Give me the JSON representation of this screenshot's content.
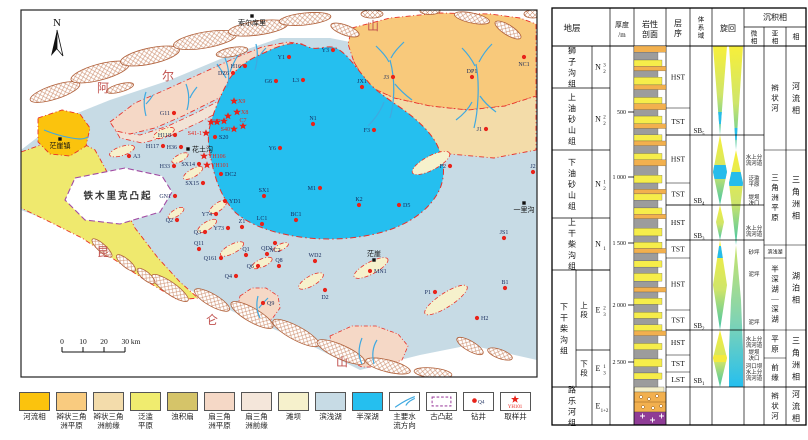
{
  "figure": {
    "bg": "#ffffff"
  },
  "map": {
    "north": "N",
    "mountain_labels": [
      {
        "t": "阿",
        "x": 103,
        "y": 92
      },
      {
        "t": "尔",
        "x": 168,
        "y": 80
      },
      {
        "t": "山",
        "x": 373,
        "y": 30
      },
      {
        "t": "昆",
        "x": 103,
        "y": 256
      },
      {
        "t": "仑",
        "x": 212,
        "y": 324
      },
      {
        "t": "山",
        "x": 342,
        "y": 366
      }
    ],
    "uplift_label": "铁木里克凸起",
    "towns": [
      {
        "n": "索尔库里",
        "x": 252,
        "y": 16,
        "p": "b"
      },
      {
        "n": "茫崖镇",
        "x": 60,
        "y": 139,
        "p": "b"
      },
      {
        "n": "花土沟",
        "x": 188,
        "y": 149,
        "p": "r"
      },
      {
        "n": "茫崖",
        "x": 374,
        "y": 260,
        "p": "t"
      },
      {
        "n": "一里沟",
        "x": 524,
        "y": 203,
        "p": "b"
      }
    ],
    "scale_bar": {
      "ticks": [
        "0",
        "10",
        "20",
        "30"
      ],
      "unit": "km"
    },
    "wells": [
      {
        "n": "H16",
        "x": 245,
        "y": 66,
        "p": "l"
      },
      {
        "n": "G6",
        "x": 276,
        "y": 81,
        "p": "l"
      },
      {
        "n": "Y1",
        "x": 289,
        "y": 57,
        "p": "l"
      },
      {
        "n": "Y3",
        "x": 333,
        "y": 50,
        "p": "l"
      },
      {
        "n": "L3",
        "x": 303,
        "y": 80,
        "p": "l"
      },
      {
        "n": "JX1",
        "x": 362,
        "y": 87,
        "p": "t"
      },
      {
        "n": "J3",
        "x": 393,
        "y": 77,
        "p": "l"
      },
      {
        "n": "DP1",
        "x": 472,
        "y": 77,
        "p": "t"
      },
      {
        "n": "NC1",
        "x": 524,
        "y": 57,
        "p": "b"
      },
      {
        "n": "J1",
        "x": 486,
        "y": 129,
        "p": "l"
      },
      {
        "n": "N1",
        "x": 313,
        "y": 124,
        "p": "t"
      },
      {
        "n": "F3",
        "x": 374,
        "y": 130,
        "p": "l"
      },
      {
        "n": "F2",
        "x": 450,
        "y": 166,
        "p": "l"
      },
      {
        "n": "J2",
        "x": 533,
        "y": 172,
        "p": "t"
      },
      {
        "n": "M1",
        "x": 320,
        "y": 188,
        "p": "l"
      },
      {
        "n": "K2",
        "x": 359,
        "y": 205,
        "p": "t"
      },
      {
        "n": "D5",
        "x": 399,
        "y": 205,
        "p": "r"
      },
      {
        "n": "BC1",
        "x": 296,
        "y": 220,
        "p": "t"
      },
      {
        "n": "JS1",
        "x": 504,
        "y": 238,
        "p": "t"
      },
      {
        "n": "B1",
        "x": 505,
        "y": 288,
        "p": "t"
      },
      {
        "n": "H2",
        "x": 477,
        "y": 318,
        "p": "r"
      },
      {
        "n": "P1",
        "x": 435,
        "y": 292,
        "p": "l"
      },
      {
        "n": "MN1",
        "x": 370,
        "y": 271,
        "p": "r"
      },
      {
        "n": "WD2",
        "x": 315,
        "y": 261,
        "p": "t"
      },
      {
        "n": "D2",
        "x": 325,
        "y": 290,
        "p": "b"
      },
      {
        "n": "Q9",
        "x": 263,
        "y": 303,
        "p": "r"
      },
      {
        "n": "Q4",
        "x": 236,
        "y": 276,
        "p": "l"
      },
      {
        "n": "Q161",
        "x": 221,
        "y": 258,
        "p": "l"
      },
      {
        "n": "Q11",
        "x": 199,
        "y": 249,
        "p": "t"
      },
      {
        "n": "Q1",
        "x": 246,
        "y": 255,
        "p": "t"
      },
      {
        "n": "QD1",
        "x": 267,
        "y": 254,
        "p": "t"
      },
      {
        "n": "Q6",
        "x": 258,
        "y": 266,
        "p": "l"
      },
      {
        "n": "Q8",
        "x": 279,
        "y": 266,
        "p": "t"
      },
      {
        "n": "Q3",
        "x": 205,
        "y": 232,
        "p": "l"
      },
      {
        "n": "Q2",
        "x": 177,
        "y": 220,
        "p": "l"
      },
      {
        "n": "Y74",
        "x": 216,
        "y": 214,
        "p": "l"
      },
      {
        "n": "Y73",
        "x": 228,
        "y": 228,
        "p": "l"
      },
      {
        "n": "Z1",
        "x": 242,
        "y": 227,
        "p": "t"
      },
      {
        "n": "LC1",
        "x": 262,
        "y": 224,
        "p": "t"
      },
      {
        "n": "YD1",
        "x": 225,
        "y": 201,
        "p": "r"
      },
      {
        "n": "GN1",
        "x": 175,
        "y": 196,
        "p": "l"
      },
      {
        "n": "SX1",
        "x": 264,
        "y": 196,
        "p": "t"
      },
      {
        "n": "NC2",
        "x": 275,
        "y": 243,
        "p": "b"
      },
      {
        "n": "A3",
        "x": 129,
        "y": 156,
        "p": "r"
      },
      {
        "n": "H117",
        "x": 163,
        "y": 146,
        "p": "l"
      },
      {
        "n": "H118",
        "x": 175,
        "y": 135,
        "p": "l"
      },
      {
        "n": "H36",
        "x": 181,
        "y": 147,
        "p": "l"
      },
      {
        "n": "H33",
        "x": 174,
        "y": 166,
        "p": "l"
      },
      {
        "n": "SX14",
        "x": 199,
        "y": 164,
        "p": "l"
      },
      {
        "n": "SX15",
        "x": 203,
        "y": 183,
        "p": "l"
      },
      {
        "n": "DC2",
        "x": 221,
        "y": 174,
        "p": "r"
      },
      {
        "n": "S20",
        "x": 215,
        "y": 137,
        "p": "r"
      },
      {
        "n": "Y6",
        "x": 280,
        "y": 148,
        "p": "l"
      },
      {
        "n": "DZ6",
        "x": 233,
        "y": 73,
        "p": "l"
      },
      {
        "n": "G11",
        "x": 174,
        "y": 113,
        "p": "l"
      }
    ],
    "sample_wells": [
      {
        "n": "X9",
        "x": 234,
        "y": 101,
        "p": "r"
      },
      {
        "n": "X8",
        "x": 237,
        "y": 112,
        "p": "r"
      },
      {
        "n": "C7",
        "x": 243,
        "y": 126,
        "p": "t"
      },
      {
        "n": "S37",
        "x": 224,
        "y": 121,
        "p": "l"
      },
      {
        "n": "S40",
        "x": 234,
        "y": 129,
        "p": "l"
      },
      {
        "n": "S41-1",
        "x": 206,
        "y": 133,
        "p": "l"
      },
      {
        "n": "YH106",
        "x": 204,
        "y": 156,
        "p": "r"
      },
      {
        "n": "YH101",
        "x": 207,
        "y": 165,
        "p": "r"
      },
      {
        "n": "",
        "x": 211,
        "y": 122,
        "p": "r"
      },
      {
        "n": "",
        "x": 217,
        "y": 122,
        "p": "r"
      },
      {
        "n": "",
        "x": 228,
        "y": 116,
        "p": "r"
      }
    ]
  },
  "legend": {
    "items": [
      {
        "label": "河流相",
        "type": "color",
        "color": "#FBC30D"
      },
      {
        "label": "辫状三角\n洲平原",
        "type": "color",
        "color": "#F9CB7F"
      },
      {
        "label": "辫状三角\n洲前缘",
        "type": "color",
        "color": "#F3DCAB"
      },
      {
        "label": "泛滥\n平原",
        "type": "color",
        "color": "#F0EC6F"
      },
      {
        "label": "浊积扇",
        "type": "color",
        "color": "#D5C469"
      },
      {
        "label": "扇三角\n洲平原",
        "type": "color",
        "color": "#F5D8C6"
      },
      {
        "label": "扇三角\n洲前缘",
        "type": "color",
        "color": "#F4E6DA"
      },
      {
        "label": "滩坝",
        "type": "color",
        "color": "#F6F1CC"
      },
      {
        "label": "滨浅湖",
        "type": "color",
        "color": "#C7DBE5"
      },
      {
        "label": "半深湖",
        "type": "color",
        "color": "#25BFEF"
      },
      {
        "label": "主要水\n流方向",
        "type": "flow"
      },
      {
        "label": "古凸起",
        "type": "uplift"
      },
      {
        "label": "钻井",
        "type": "well",
        "sub": "Q4"
      },
      {
        "label": "取样井",
        "type": "sample",
        "sub": "YH101"
      }
    ]
  },
  "column": {
    "header": {
      "strat": "地层",
      "thick1": "厚度",
      "thick2": "/m",
      "lith1": "岩性",
      "lith2": "剖面",
      "seq": "层序",
      "tract": "体系域",
      "cycle": "旋回",
      "sed": "沉积相",
      "micro": "微相",
      "sub": "亚相",
      "facies": "相"
    },
    "formations": [
      {
        "name": "狮子沟组",
        "code": {
          "b": "N",
          "sub": "2",
          "sup": "3"
        },
        "y0": 46,
        "y1": 88
      },
      {
        "name": "上油砂山组",
        "code": {
          "b": "N",
          "sub": "2",
          "sup": "2"
        },
        "y0": 88,
        "y1": 150
      },
      {
        "name": "下油砂山组",
        "code": {
          "b": "N",
          "sub": "2",
          "sup": "1"
        },
        "y0": 150,
        "y1": 218
      },
      {
        "name": "上干柴沟组",
        "code": {
          "b": "N",
          "sub": "1",
          "sup": ""
        },
        "y0": 218,
        "y1": 270
      },
      {
        "name": "下干柴沟组",
        "y0": 270,
        "y1": 387,
        "segs": [
          {
            "name": "上段",
            "code": {
              "b": "E",
              "sub": "3",
              "sup": "2"
            },
            "y0": 270,
            "y1": 350
          },
          {
            "name": "下段",
            "code": {
              "b": "E",
              "sub": "3",
              "sup": "1"
            },
            "y0": 350,
            "y1": 387
          }
        ]
      },
      {
        "name": "路乐河组",
        "code": {
          "b": "E",
          "sub": "1+2",
          "sup": ""
        },
        "y0": 387,
        "y1": 425
      }
    ],
    "depth_ticks": [
      {
        "v": "500",
        "y": 112
      },
      {
        "v": "1 000",
        "y": 177
      },
      {
        "v": "1 500",
        "y": 243
      },
      {
        "v": "2 000",
        "y": 305
      },
      {
        "v": "2 500",
        "y": 362
      }
    ],
    "tracts": [
      {
        "l": "HST",
        "y0": 46,
        "y1": 108
      },
      {
        "l": "TST",
        "y0": 108,
        "y1": 135
      },
      {
        "l": "HST",
        "y0": 135,
        "y1": 183
      },
      {
        "l": "TST",
        "y0": 183,
        "y1": 205
      },
      {
        "l": "HST",
        "y0": 205,
        "y1": 240
      },
      {
        "l": "TST",
        "y0": 240,
        "y1": 258
      },
      {
        "l": "HST",
        "y0": 258,
        "y1": 310
      },
      {
        "l": "TST",
        "y0": 310,
        "y1": 330
      },
      {
        "l": "HST",
        "y0": 330,
        "y1": 355
      },
      {
        "l": "TST",
        "y0": 355,
        "y1": 372
      },
      {
        "l": "LST",
        "y0": 372,
        "y1": 387
      }
    ],
    "sequence_boundaries": [
      {
        "l": "SB",
        "n": "5",
        "y": 131
      },
      {
        "l": "SB",
        "n": "4",
        "y": 201
      },
      {
        "l": "SB",
        "n": "3",
        "y": 236
      },
      {
        "l": "SB",
        "n": "2",
        "y": 326
      },
      {
        "l": "SB",
        "n": "1",
        "y": 381
      }
    ],
    "microfacies": [
      {
        "lines": [
          "水上分",
          "流河道"
        ],
        "y": 160
      },
      {
        "lines": [
          "泛滥",
          "平原"
        ],
        "y": 181
      },
      {
        "lines": [
          "堤坝",
          "决口"
        ],
        "y": 200
      },
      {
        "lines": [
          "水上分",
          "流河道"
        ],
        "y": 231
      },
      {
        "lines": [
          "砂坪"
        ],
        "y": 252
      },
      {
        "lines": [
          "泥坪"
        ],
        "y": 274
      },
      {
        "lines": [
          "泥坪"
        ],
        "y": 322
      },
      {
        "lines": [
          "水上分",
          "流河道"
        ],
        "y": 342
      },
      {
        "lines": [
          "堤坝",
          "决口"
        ],
        "y": 355
      },
      {
        "lines": [
          "河口坝",
          "水上分",
          "流河道"
        ],
        "y": 372
      }
    ],
    "subfacies": [
      {
        "t": "辫状河",
        "y0": 46,
        "y1": 150
      },
      {
        "t": "三角洲平原",
        "y0": 150,
        "y1": 245
      },
      {
        "t": "滨浅湖",
        "y0": 245,
        "y1": 258,
        "small": true
      },
      {
        "t": "半深湖—深湖",
        "y0": 258,
        "y1": 330
      },
      {
        "t": "平原",
        "y0": 330,
        "y1": 358
      },
      {
        "t": "前缘",
        "y0": 358,
        "y1": 387
      },
      {
        "t": "辫状河",
        "y0": 387,
        "y1": 425
      }
    ],
    "facies": [
      {
        "t": "河流相",
        "y0": 46,
        "y1": 150
      },
      {
        "t": "三角洲相",
        "y0": 150,
        "y1": 245
      },
      {
        "t": "湖泊相",
        "y0": 245,
        "y1": 330
      },
      {
        "t": "三角洲相",
        "y0": 330,
        "y1": 387
      },
      {
        "t": "河流相",
        "y0": 387,
        "y1": 425
      }
    ],
    "beds": "o4 g5 y4 o3 g4 y5 o3 g5 y4 o4 g4 y5 o3 g4 y4 o3 g5 y4 o4 g6 y5 g4 o3 y4 g5 y4 o3 g6 y5 g4 y4 o3 g5 y4 g4 y5 g4 o3 g4 y4 g5 y4 g4 y4 o3 g5 y4 g6 y5 g4 y4 g5"
  },
  "colors": {
    "well_dot": "#E8231A",
    "well_label": "#16295B",
    "sample_label": "#E8231A",
    "facies_boundary": "#E8312A",
    "uplift_border": "#A24BA3",
    "river": "#3FA9E0",
    "deep_lake": "#25BFEF",
    "shallow_lake": "#C7DBE5",
    "mountain_label": "#C0504D"
  }
}
